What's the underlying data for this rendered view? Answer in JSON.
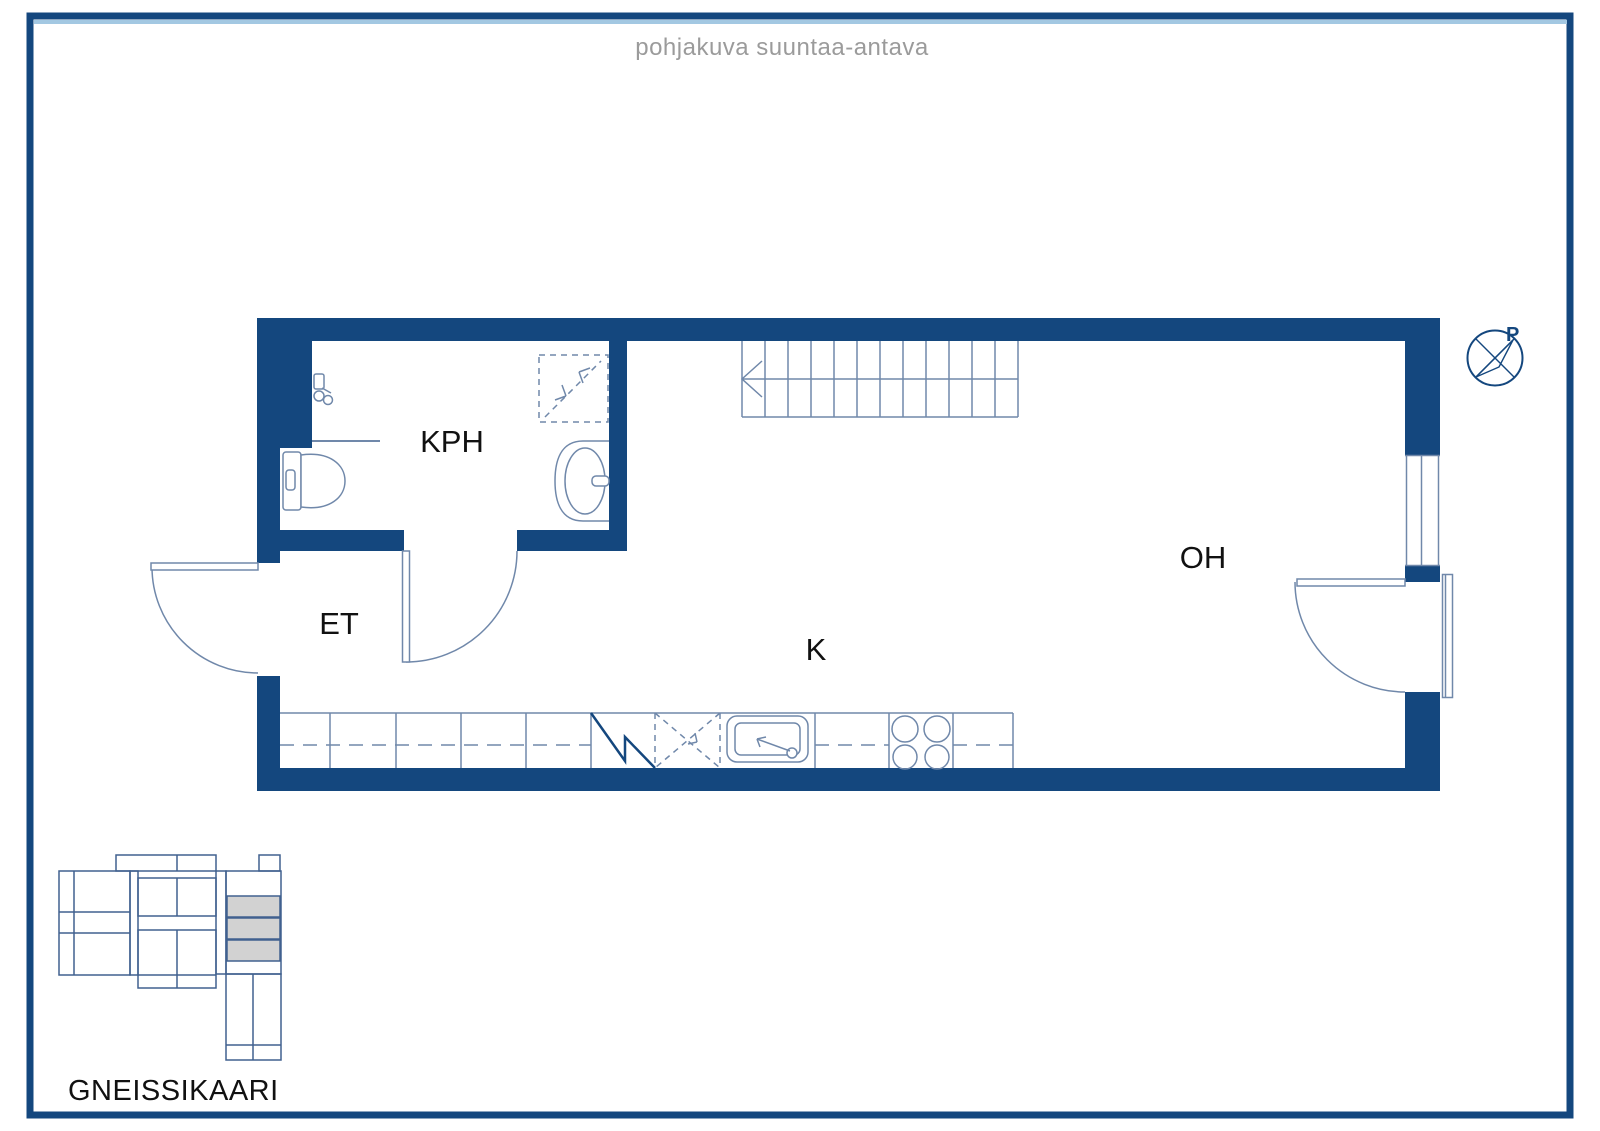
{
  "title": "pohjakuva suuntaa-antava",
  "rooms": {
    "bathroom": "KPH",
    "entry": "ET",
    "kitchen": "K",
    "living": "OH"
  },
  "compass": {
    "label": "P"
  },
  "site": {
    "name": "GNEISSIKAARI"
  },
  "theme": {
    "wall": "#14477e",
    "line": "#7088aa",
    "map-line": "#41618f",
    "map-fill": "#d2d2d2",
    "accent": "#a3c8e2",
    "title-color": "#9b9b9b",
    "text": "#111111"
  }
}
